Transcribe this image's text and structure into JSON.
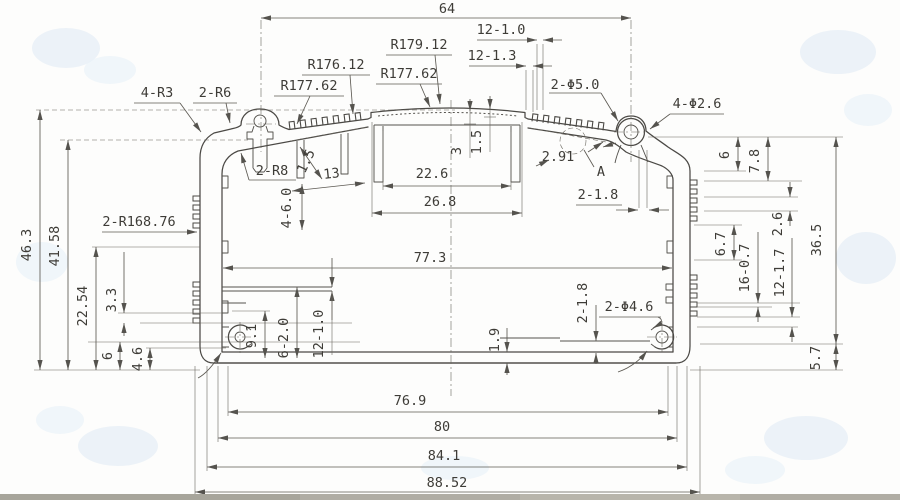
{
  "colors": {
    "paper": "#fdfdfc",
    "line": "#4b4945",
    "dimension": "#5d5a53",
    "text": "#3e3c37",
    "watermark": "#dfeaf4",
    "footer_strip": "#b0ada4"
  },
  "labels": {
    "d64": "64",
    "d12_10_top": "12-1.0",
    "d12_13": "12-1.3",
    "r179_12": "R179.12",
    "r176_12": "R176.12",
    "r177_62_a": "R177.62",
    "r177_62_b": "R177.62",
    "hole_2_50": "2-Φ5.0",
    "hole_4_26": "4-Φ2.6",
    "rad_4_r3": "4-R3",
    "rad_2_r6": "2-R6",
    "rad_2_r8": "2-R8",
    "d3": "3",
    "d1_5": "1.5",
    "d2_91": "2.91",
    "detail_a": "A",
    "d22_6": "22.6",
    "d26_8": "26.8",
    "slant_1_5": "1.5",
    "slant_13": "13",
    "d2_18_top": "2-1.8",
    "d4_60": "4-6.0",
    "d77_3": "77.3",
    "d46_3": "46.3",
    "d41_58": "41.58",
    "r168_76": "2-R168.76",
    "d22_54": "22.54",
    "d3_3": "3.3",
    "d6_left": "6",
    "d4_6": "4.6",
    "d9_1": "9.1",
    "d6_20": "6-2.0",
    "d12_10_bottom": "12-1.0",
    "d1_9": "1.9",
    "d2_18_bottom": "2-1.8",
    "hole_2_46": "2-Φ4.6",
    "d6_right": "6",
    "d7_8": "7.8",
    "d2_6": "2.6",
    "d36_5": "36.5",
    "d6_7": "6.7",
    "d16_07": "16-0.7",
    "d12_17": "12-1.7",
    "d5_7": "5.7",
    "d76_9": "76.9",
    "d80": "80",
    "d84_1": "84.1",
    "d88_52": "88.52"
  }
}
